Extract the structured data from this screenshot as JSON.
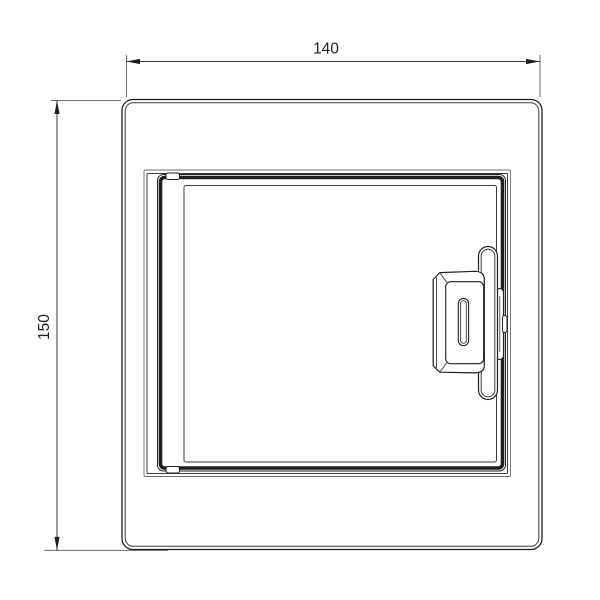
{
  "drawing": {
    "dimensions": {
      "width": {
        "value": "140"
      },
      "height": {
        "value": "150"
      }
    },
    "colors": {
      "background": "#ffffff",
      "line_strong": "#1f1f1f",
      "line_medium": "#3a3a3a",
      "line_light": "#6b6b6b"
    }
  }
}
